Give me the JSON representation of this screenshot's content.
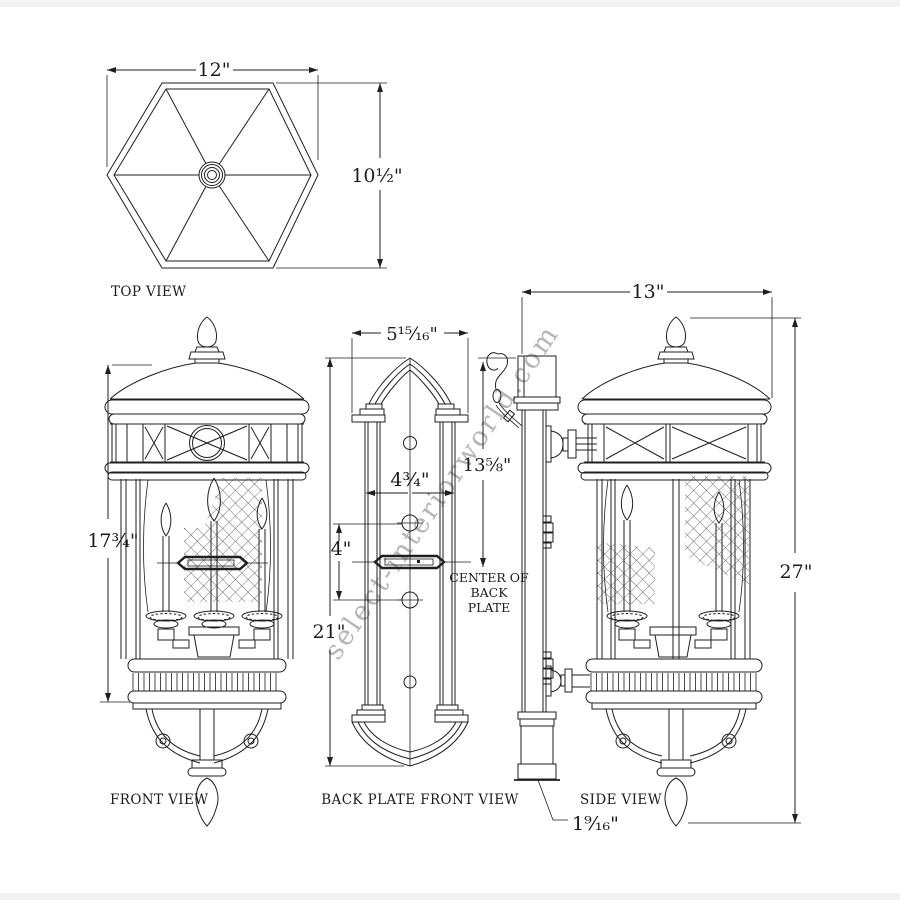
{
  "colors": {
    "line": "#1f1f1f",
    "background": "#ffffff",
    "watermark": "#b6b6b6"
  },
  "watermark": "select-interiorworld.com",
  "top_view": {
    "label": "TOP VIEW",
    "width": "12\"",
    "height": "10½\""
  },
  "front_view": {
    "label": "FRONT VIEW",
    "height": "17¾\""
  },
  "back_plate_view": {
    "label": "BACK PLATE FRONT VIEW",
    "top_width": "5¹⁵⁄₁₆\"",
    "inner_width": "4¾\"",
    "mount_hole_spacing": "4\"",
    "height": "21\"",
    "center_note": [
      "CENTER OF",
      "BACK",
      "PLATE"
    ]
  },
  "side_view": {
    "label": "SIDE VIEW",
    "width": "13\"",
    "top_to_center": "13⅝\"",
    "height": "27\"",
    "back_plate_depth": "1⁹⁄₁₆\""
  }
}
